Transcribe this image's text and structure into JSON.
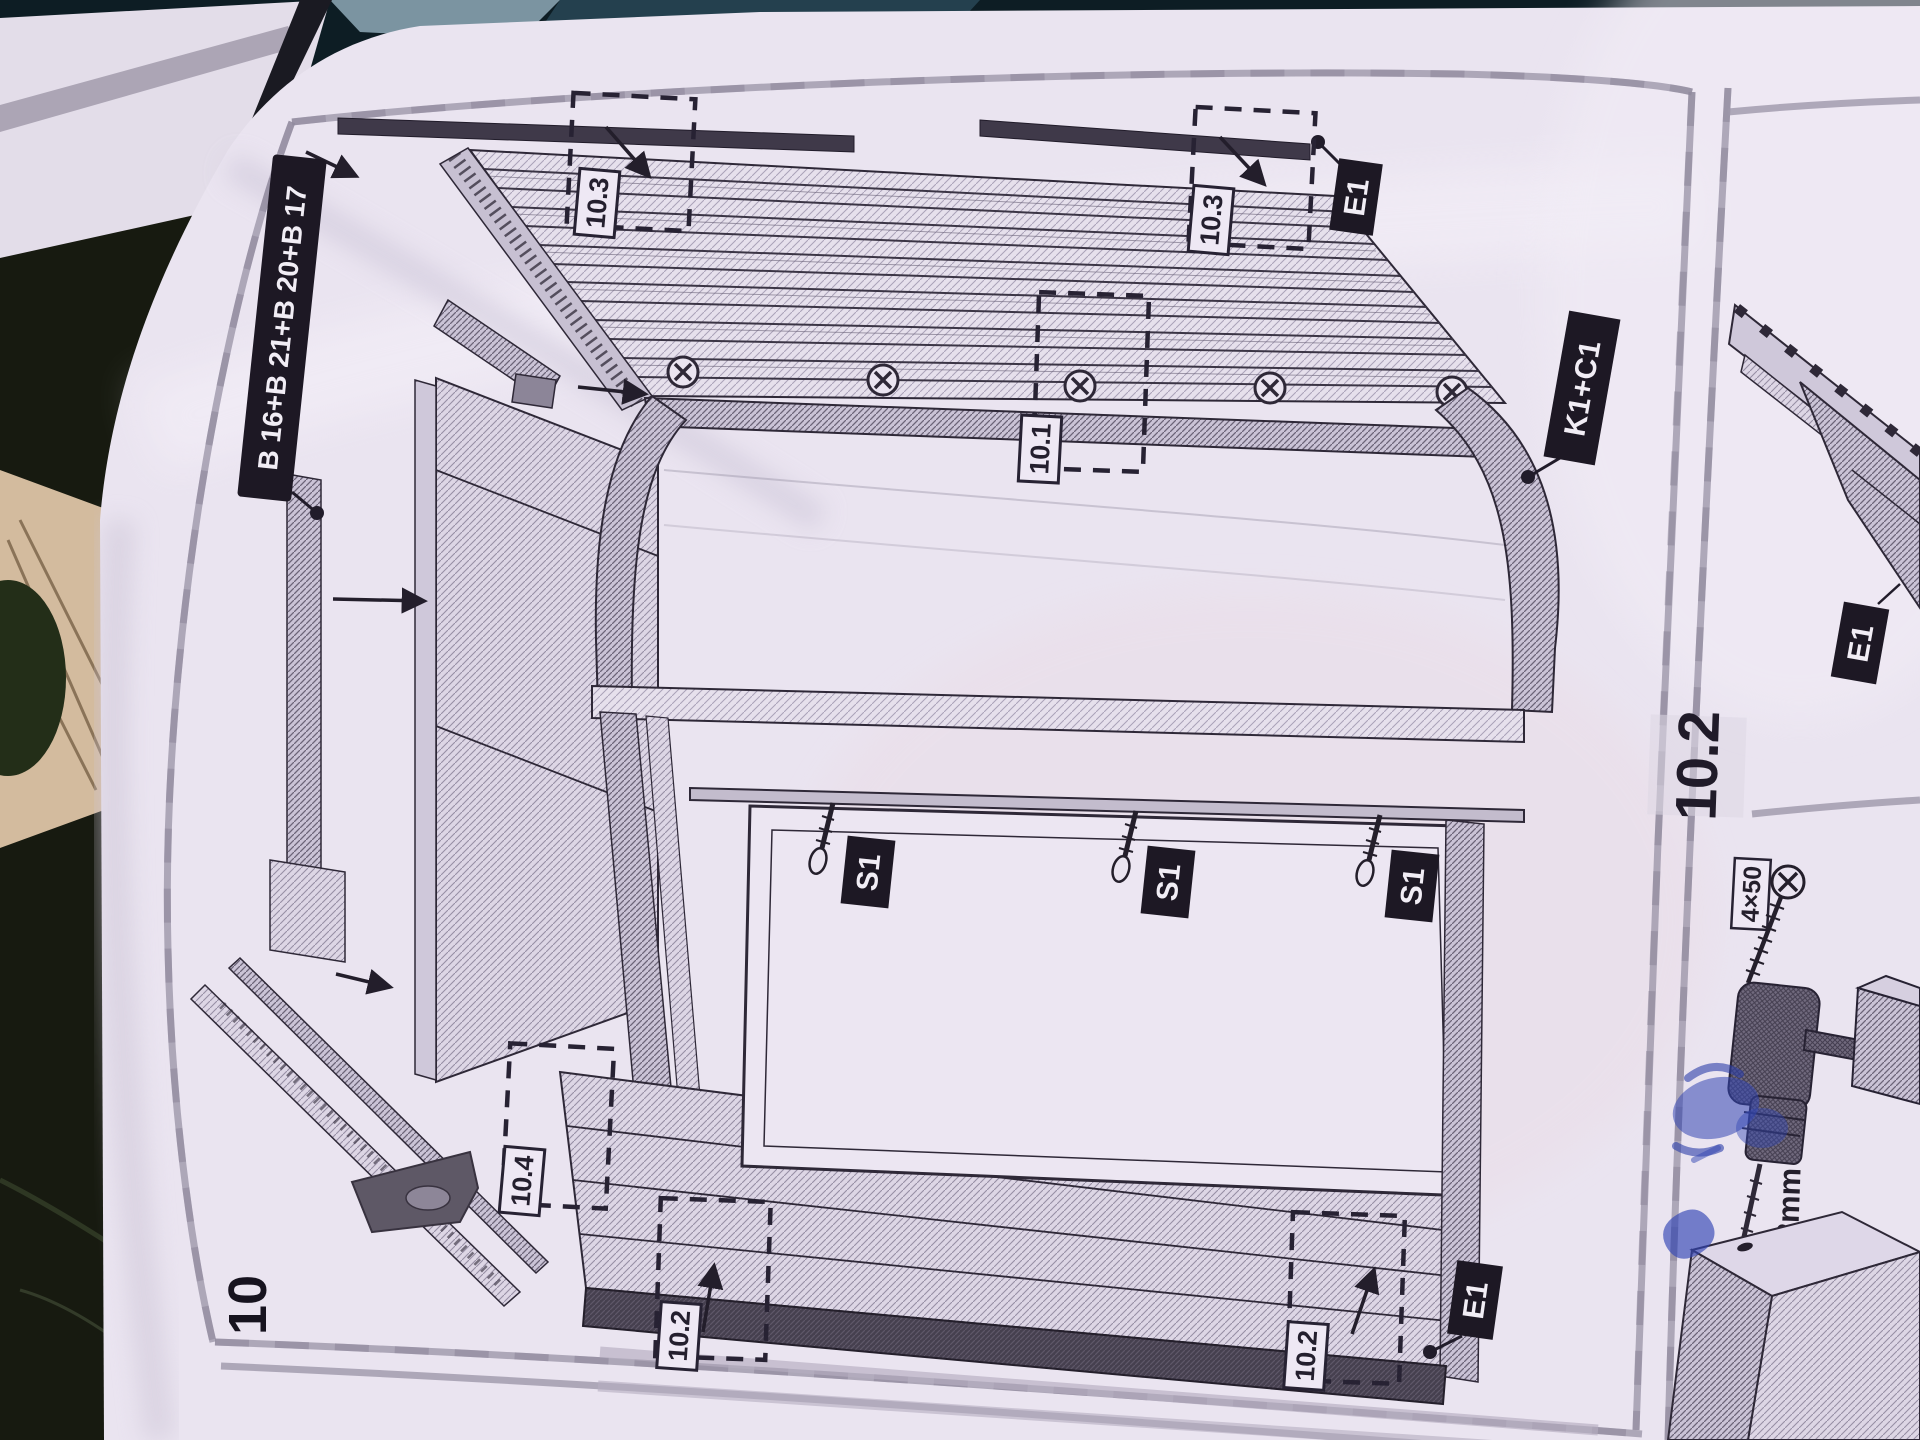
{
  "page": {
    "step_number": "10"
  },
  "main_panel": {
    "callouts": {
      "roof_slats": "B 16+B 21+B 20+B 17",
      "top_batten": "E1",
      "arch": "K1+C1",
      "screws": [
        "S1",
        "S1",
        "S1"
      ],
      "bottom_batten": "E1"
    },
    "details": {
      "top_left": "10.3",
      "top_right": "10.3",
      "center": "10.1",
      "mid_left": "10.4",
      "bottom_left": "10.2",
      "bottom_right": "10.2"
    }
  },
  "side_panel": {
    "header": "10.2",
    "callout_batten": "E1",
    "screw_size": "4×50",
    "drill_diameter": "Ø3mm"
  },
  "colors": {
    "paper": "#eae4f0",
    "ink": "#2e2837",
    "label_bg": "#1d1824",
    "label_text": "#f1edf5",
    "border_gray": "#9e97aa",
    "blue_ink": "#3346b3"
  }
}
